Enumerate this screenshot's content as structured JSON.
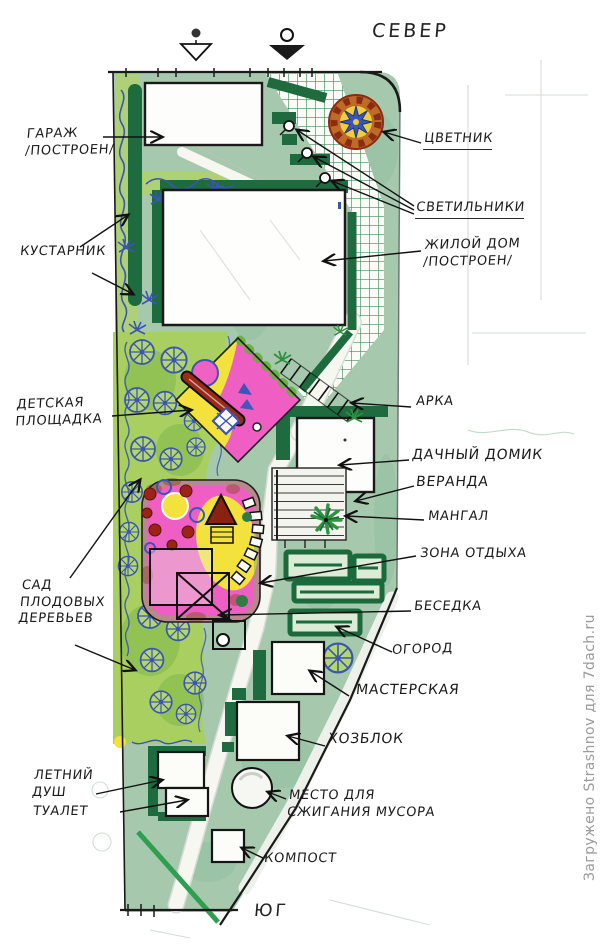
{
  "compass": {
    "north": "СЕВЕР",
    "south": "ЮГ"
  },
  "watermark": "Загружено Strashnov для 7dach.ru",
  "labels": {
    "garage": "ГАРАЖ\n/ПОСТРОЕН/",
    "shrubs": "КУСТАРНИК",
    "playground": "ДЕТСКАЯ\nПЛОЩАДКА",
    "orchard": "САД\nПЛОДОВЫХ\nДЕРЕВЬЕВ",
    "summer_shower": "ЛЕТНИЙ\nДУШ",
    "toilet": "ТУАЛЕТ",
    "flower_garden": "ЦВЕТНИК",
    "lights": "СВЕТИЛЬНИКИ",
    "house": "ЖИЛОЙ ДОМ\n/ПОСТРОЕН/",
    "arch": "АРКА",
    "dacha_house": "ДАЧНЫЙ ДОМИК",
    "veranda": "ВЕРАНДА",
    "bbq": "МАНГАЛ",
    "rest_zone": "ЗОНА ОТДЫХА",
    "gazebo": "БЕСЕДКА",
    "vegetable_garden": "ОГОРОД",
    "workshop": "МАСТЕРСКАЯ",
    "utility_block": "ХОЗБЛОК",
    "burning_place": "МЕСТО ДЛЯ\nСЖИГАНИЯ МУСОРА",
    "compost": "КОМПОСТ"
  },
  "colors": {
    "lawn_sage": "#a6c9ae",
    "lawn_bright": "#a9cf62",
    "hedge_dark_green": "#1d6b3e",
    "tree_blue": "#3a55b2",
    "zone_pink": "#ef5ec2",
    "zone_yellow": "#f3e23c",
    "accent_red": "#9c2a16",
    "flower_orange": "#bf6a26",
    "ink": "#1a1a1a",
    "watermark_gray": "#9b9b9b"
  }
}
